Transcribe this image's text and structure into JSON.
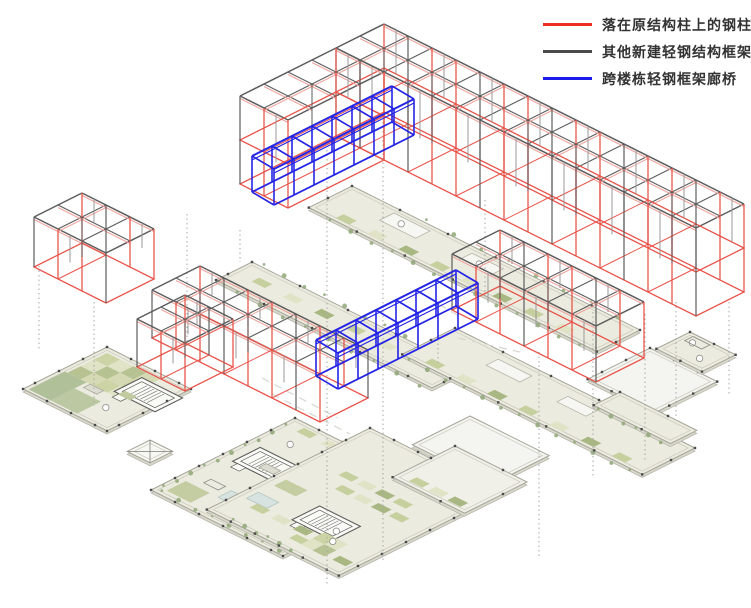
{
  "legend": {
    "entries": [
      {
        "id": "original-structure-columns",
        "color": "#ee2e24",
        "label": "落在原结构柱上的钢柱"
      },
      {
        "id": "new-light-steel-frame",
        "color": "#4a4a4a",
        "label": "其他新建轻钢结构框架"
      },
      {
        "id": "cross-building-bridge",
        "color": "#1c1ce8",
        "label": "跨楼栋轻钢框架廊桥"
      }
    ]
  },
  "colors": {
    "red": "#e8564c",
    "red_light": "#f2a49c",
    "gray_dark": "#5d5d5d",
    "gray_mid": "#9a9a9a",
    "blue": "#2424e6",
    "plan_fill": "#ecebdf",
    "court_fill": "#f4f4f0",
    "plan_stroke": "#a3a296",
    "plan_inner": "#c9c8bb",
    "plan_edge": "#d9d8cc",
    "dot": "#4a4a4a",
    "dotted_line": "#a6a6a6",
    "dash_line": "#d8d8d2",
    "tree": "#8fa877",
    "pool": "#d7e3e0"
  },
  "scene": {
    "canvas": {
      "width": 751,
      "height": 608
    },
    "iso": {
      "ux": 24,
      "uy": 12
    },
    "frames": [
      {
        "id": "left-block",
        "a": [
          82,
          193
        ],
        "nu": 3,
        "nv": 2,
        "h": 50,
        "stories": 1
      },
      {
        "id": "bar-b",
        "a": [
          200,
          266
        ],
        "nu": 7,
        "nv": 2,
        "h": 48,
        "stories": 1
      },
      {
        "id": "bar-b-wing",
        "a": [
          185,
          295
        ],
        "nu": 2,
        "nv": 2,
        "h": 48,
        "stories": 1
      },
      {
        "id": "east-block",
        "a": [
          500,
          230
        ],
        "nu": 6,
        "nv": 2,
        "h": 56,
        "stories": 1
      },
      {
        "id": "bar-a",
        "a": [
          384,
          24
        ],
        "nu": 15,
        "nv": 2,
        "h": 44,
        "stories": 2
      },
      {
        "id": "bar-a-wing",
        "a": [
          336,
          48
        ],
        "nu": 2,
        "nv": 4,
        "h": 44,
        "stories": 2
      }
    ],
    "bridges": [
      {
        "id": "upper-bridge",
        "a": [
          392,
          86
        ],
        "n": 7,
        "bay": [
          -20,
          10
        ],
        "d": [
          22,
          13
        ],
        "h": 36
      },
      {
        "id": "lower-bridge",
        "a": [
          456,
          270
        ],
        "n": 7,
        "bay": [
          -20,
          10
        ],
        "d": [
          22,
          13
        ],
        "h": 36
      }
    ],
    "slabs": [
      {
        "id": "walkway-band-mid",
        "a": [
          352,
          186
        ],
        "nu": 12,
        "nv": 1.8,
        "fill": "#ecebdf",
        "dots": 2,
        "features": [
          {
            "t": "trees",
            "u0": 1.0,
            "v0": 1.92,
            "u1": 11.4,
            "v1": 1.92,
            "n": 13
          },
          {
            "t": "trees",
            "u0": 3.0,
            "v0": -0.1,
            "u1": 11.0,
            "v1": -0.1,
            "n": 8
          },
          {
            "t": "strip",
            "u": 1.0,
            "v": 1.35,
            "n": 8,
            "step": 1.3
          },
          {
            "t": "rect",
            "u": 2.0,
            "v": 0.25,
            "w": 1.5,
            "h": 0.6,
            "fill": "#f6f6f2",
            "stroke": "#b5b4a8"
          },
          {
            "t": "rect",
            "u": 5.3,
            "v": 0.3,
            "w": 1.3,
            "h": 0.55,
            "fill": "#f6f6f2",
            "stroke": "#b5b4a8"
          },
          {
            "t": "mark",
            "u": 2.6,
            "v": 0.55
          },
          {
            "t": "mark",
            "u": 5.9,
            "v": 0.6
          }
        ]
      },
      {
        "id": "walkway-band-west",
        "a": [
          252,
          262
        ],
        "nu": 9,
        "nv": 1.5,
        "fill": "#ecebdf",
        "dots": 2,
        "features": [
          {
            "t": "trees",
            "u0": 0.4,
            "v0": -0.1,
            "u1": 8.8,
            "v1": -0.1,
            "n": 11
          },
          {
            "t": "trees",
            "u0": 1.0,
            "v0": 1.62,
            "u1": 8.6,
            "v1": 1.62,
            "n": 9
          },
          {
            "t": "strip",
            "u": 0.8,
            "v": 0.5,
            "n": 6,
            "step": 1.3
          }
        ]
      },
      {
        "id": "walkway-band-east",
        "a": [
          455,
          328
        ],
        "nu": 10,
        "nv": 2.2,
        "fill": "#ecebdf",
        "dots": 2,
        "features": [
          {
            "t": "trees",
            "u0": 0.4,
            "v0": 2.32,
            "u1": 9.6,
            "v1": 2.32,
            "n": 13
          },
          {
            "t": "strip",
            "u": 0.8,
            "v": 1.75,
            "n": 7,
            "step": 1.3
          },
          {
            "t": "rect",
            "u": 2.2,
            "v": 0.4,
            "w": 1.4,
            "h": 0.5,
            "fill": "#f6f6f2",
            "stroke": "#b5b4a8"
          },
          {
            "t": "rect",
            "u": 5.2,
            "v": 0.5,
            "w": 1.2,
            "h": 0.45,
            "fill": "#f6f6f2",
            "stroke": "#b5b4a8"
          }
        ]
      },
      {
        "id": "court-east",
        "a": [
          650,
          348
        ],
        "nu": 2.8,
        "nv": 2.6,
        "fill": "#f4f4f0",
        "dots": 1,
        "features": []
      },
      {
        "id": "plan-east-end",
        "a": [
          690,
          332
        ],
        "nu": 1.9,
        "nv": 1.4,
        "fill": "#ecebdf",
        "dots": 1,
        "features": [
          {
            "t": "mark",
            "u": 0.5,
            "v": 0.4
          },
          {
            "t": "mark",
            "u": 1.3,
            "v": 0.9
          },
          {
            "t": "rect",
            "u": 0.25,
            "v": 0.12,
            "w": 0.7,
            "h": 0.35,
            "fill": "none",
            "stroke": "#8d8d89"
          }
        ]
      },
      {
        "id": "plan-left",
        "a": [
          107,
          347
        ],
        "nu": 3.5,
        "nv": 3.5,
        "fill": "#ecebdf",
        "dots": 1,
        "features": [
          {
            "t": "checker",
            "u": 0.25,
            "v": 0.25,
            "cols": 4,
            "rows": 3,
            "cell": 0.55
          },
          {
            "t": "rect",
            "u": 0.15,
            "v": 1.9,
            "w": 0.9,
            "h": 1.5,
            "fill": "#b0c098"
          },
          {
            "t": "rect",
            "u": 1.05,
            "v": 2.4,
            "w": 1.1,
            "h": 1.0,
            "fill": "#bcc8a2"
          },
          {
            "t": "stair",
            "u": 2.0,
            "v": 0.55
          },
          {
            "t": "rect",
            "u": 1.2,
            "v": 1.9,
            "w": 0.55,
            "h": 0.28,
            "fill": "#dddcd0",
            "stroke": "#a9a89c"
          },
          {
            "t": "rect",
            "u": 2.2,
            "v": 1.45,
            "w": 0.5,
            "h": 0.3,
            "fill": "#c0ca9e"
          },
          {
            "t": "mark",
            "u": 2.5,
            "v": 2.55
          }
        ]
      },
      {
        "id": "walkway-east-end",
        "a": [
          620,
          392
        ],
        "nu": 3.2,
        "nv": 1.1,
        "fill": "#ecebdf",
        "dots": 2,
        "features": [
          {
            "t": "trees",
            "u0": 0.3,
            "v0": 1.2,
            "u1": 2.9,
            "v1": 1.2,
            "n": 6
          }
        ]
      },
      {
        "id": "plan-center",
        "a": [
          295,
          418
        ],
        "nu": 5.5,
        "nv": 6,
        "fill": "#ecebdf",
        "dots": 1,
        "features": [
          {
            "t": "trees",
            "u0": 0.12,
            "v0": 0.5,
            "u1": 0.12,
            "v1": 5.6,
            "n": 10
          },
          {
            "t": "trees",
            "u0": 0.3,
            "v0": 5.85,
            "u1": 5.2,
            "v1": 5.85,
            "n": 8
          },
          {
            "t": "strip",
            "u": 0.6,
            "v": 0.22,
            "n": 5,
            "step": 1.0
          },
          {
            "t": "stair",
            "u": 0.5,
            "v": 1.95
          },
          {
            "t": "pool",
            "u": 1.7,
            "v": 4.35,
            "w": 0.85,
            "h": 0.55
          },
          {
            "t": "rect",
            "u": 0.35,
            "v": 4.9,
            "w": 1.0,
            "h": 0.8,
            "fill": "#c3cda1"
          },
          {
            "t": "rect",
            "u": 1.3,
            "v": 2.5,
            "w": 0.6,
            "h": 0.3,
            "fill": "#dddcd0",
            "stroke": "#a9a89c"
          },
          {
            "t": "rect",
            "u": 0.8,
            "v": 4.3,
            "w": 0.6,
            "h": 0.3,
            "fill": "none",
            "stroke": "#8d8d89"
          },
          {
            "t": "mark",
            "u": 1.0,
            "v": 1.2
          },
          {
            "t": "rect",
            "u": 2.6,
            "v": 1.3,
            "w": 0.9,
            "h": 0.4,
            "fill": "#f6f6f2",
            "stroke": "#b5b4a8"
          }
        ]
      },
      {
        "id": "court-center",
        "a": [
          470,
          416
        ],
        "nu": 3.3,
        "nv": 2.4,
        "fill": "#f4f4f0",
        "dots": 0,
        "features": []
      },
      {
        "id": "plan-south",
        "a": [
          370,
          428
        ],
        "nu": 5.5,
        "nv": 6.8,
        "fill": "#ecebdf",
        "dots": 1,
        "features": [
          {
            "t": "stair",
            "u": 2.2,
            "v": 4.3
          },
          {
            "t": "pool",
            "u": 0.35,
            "v": 5.0,
            "w": 0.85,
            "h": 0.5
          },
          {
            "t": "strip",
            "u": 1.3,
            "v": 2.3,
            "n": 4,
            "step": 0.75
          },
          {
            "t": "strip",
            "u": 1.8,
            "v": 2.95,
            "n": 4,
            "step": 0.75
          },
          {
            "t": "strip",
            "u": 0.8,
            "v": 5.5,
            "n": 3,
            "step": 0.9
          },
          {
            "t": "strip",
            "u": 2.9,
            "v": 5.95,
            "n": 3,
            "step": 0.9
          },
          {
            "t": "rect",
            "u": 0.4,
            "v": 3.9,
            "w": 0.9,
            "h": 0.5,
            "fill": "#c3cda1"
          },
          {
            "t": "checker",
            "u": 3.4,
            "v": 5.3,
            "cols": 2,
            "rows": 2,
            "cell": 0.5
          },
          {
            "t": "trees",
            "u0": 1.0,
            "v0": 6.7,
            "u1": 3.4,
            "v1": 6.7,
            "n": 6
          },
          {
            "t": "mark",
            "u": 3.6,
            "v": 5.0
          },
          {
            "t": "mark",
            "u": 3.95,
            "v": 5.5
          }
        ]
      },
      {
        "id": "plan-south-east",
        "a": [
          455,
          446
        ],
        "nu": 3,
        "nv": 2.6,
        "fill": "#f1f0e8",
        "dots": 2,
        "features": [
          {
            "t": "strip",
            "u": 0.5,
            "v": 2.1,
            "n": 3,
            "step": 0.8
          }
        ]
      },
      {
        "id": "canopy-x",
        "a": [
          150,
          440
        ],
        "nu": 0.95,
        "nv": 0.95,
        "fill": "#f7f7f3",
        "dots": 0,
        "features": [
          {
            "t": "xbox"
          }
        ]
      }
    ],
    "dotted": [
      [
        39,
        266,
        350
      ],
      [
        94,
        302,
        406
      ],
      [
        187,
        214,
        346
      ],
      [
        240,
        230,
        262
      ],
      [
        327,
        150,
        585
      ],
      [
        383,
        122,
        560
      ],
      [
        438,
        312,
        366
      ],
      [
        485,
        200,
        298
      ],
      [
        539,
        352,
        556
      ],
      [
        593,
        312,
        478
      ],
      [
        645,
        314,
        460
      ],
      [
        676,
        302,
        418
      ],
      [
        729,
        302,
        396
      ]
    ],
    "dashes": [
      [
        262,
        378,
        338,
        418
      ],
      [
        272,
        394,
        350,
        434
      ],
      [
        458,
        338,
        520,
        352
      ],
      [
        415,
        290,
        462,
        318
      ]
    ]
  }
}
